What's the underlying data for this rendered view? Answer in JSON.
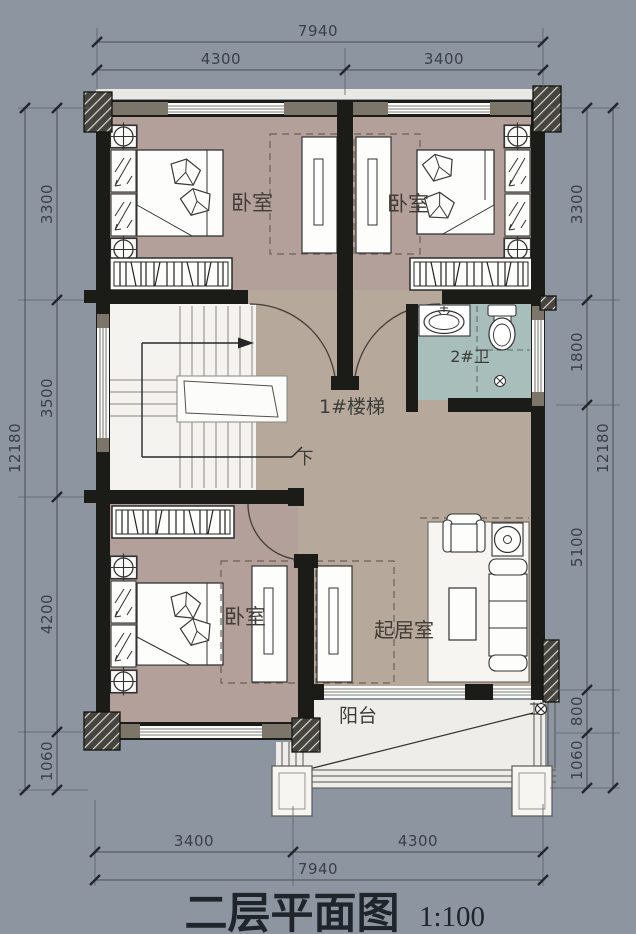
{
  "title": {
    "text": "二层平面图",
    "scale": "1:100"
  },
  "dims": {
    "top": {
      "total": "7940",
      "seg1": "4300",
      "seg2": "3400"
    },
    "bottom": {
      "seg1": "3400",
      "seg2": "4300",
      "total": "7940"
    },
    "left": {
      "seg1": "3300",
      "seg2": "3500",
      "seg3": "4200",
      "seg4": "1060",
      "total": "12180"
    },
    "right": {
      "seg1": "3300",
      "seg2": "1800",
      "seg3": "5100",
      "seg4": "800",
      "seg5": "1060",
      "total": "12180"
    }
  },
  "rooms": {
    "bedroom_top_left": "卧室",
    "bedroom_top_right": "卧室",
    "bedroom_bottom": "卧室",
    "bathroom": "2#卫",
    "stair": "1#楼梯",
    "stair_down": "下",
    "living": "起居室",
    "balcony": "阳台"
  },
  "colors": {
    "background": "#8c95a0",
    "wall": "#1b1b18",
    "lintel": "#7c756a",
    "bedroom_floor": "#b3a09b",
    "hall_floor": "#b6a89a",
    "bath_floor": "#a8beba",
    "stair_floor": "#f4f3f0",
    "dim_line": "#3a4047"
  }
}
